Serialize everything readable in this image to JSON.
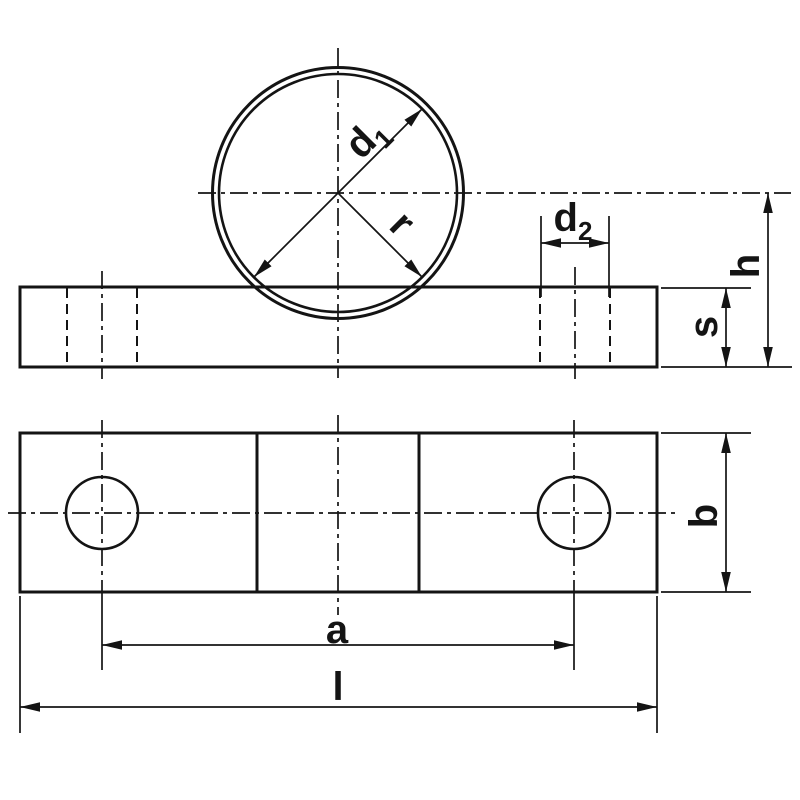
{
  "colors": {
    "line": "#141414",
    "background": "#ffffff"
  },
  "labels": {
    "d1": {
      "base": "d",
      "sub": "1"
    },
    "d2": {
      "base": "d",
      "sub": "2"
    },
    "r": "r",
    "h": "h",
    "s": "s",
    "b": "b",
    "a": "a",
    "l": "l"
  }
}
